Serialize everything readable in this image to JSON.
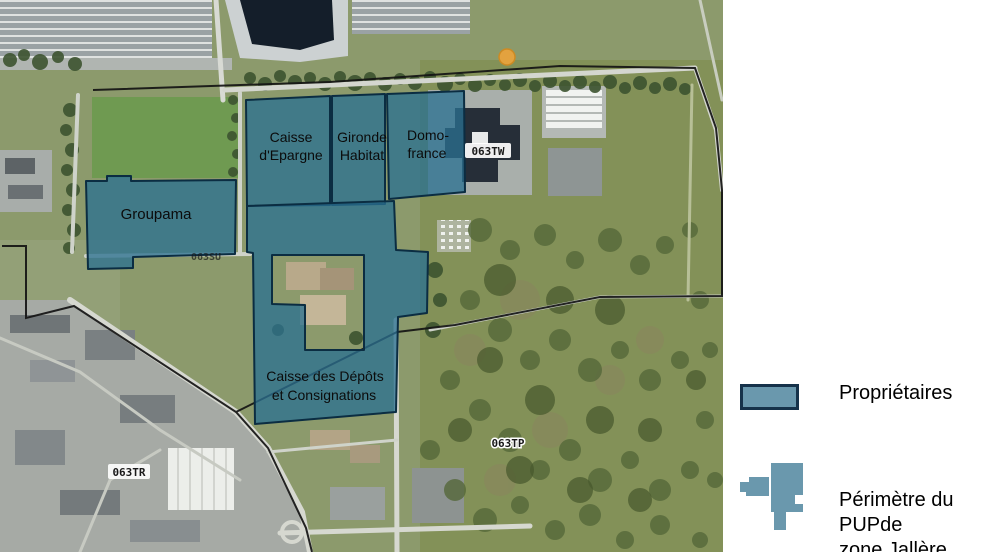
{
  "map": {
    "parcels": [
      {
        "id": "groupama",
        "lines": [
          "Groupama"
        ]
      },
      {
        "id": "caisse-epargne",
        "lines": [
          "Caisse",
          "d'Epargne"
        ]
      },
      {
        "id": "gironde-habitat",
        "lines": [
          "Gironde",
          "Habitat"
        ]
      },
      {
        "id": "domo-france",
        "lines": [
          "Domo-",
          "france"
        ]
      },
      {
        "id": "caisse-des-depots",
        "lines": [
          "Caisse des Dépôts",
          "et Consignations"
        ]
      }
    ],
    "road_labels": [
      {
        "code": "063TW"
      },
      {
        "code": "063TP"
      },
      {
        "code": "063TR"
      },
      {
        "code": "063SU"
      }
    ],
    "overlay_fill": "#2a7090",
    "overlay_outline": "#0b2d42",
    "perimeter_line": "#141414",
    "poi_dot_color": "#e8a33d"
  },
  "legend": {
    "items": [
      {
        "label": "Propriétaires",
        "swatch_color": "#6a98ad",
        "swatch_border": "#16324a"
      },
      {
        "lines": [
          "Périmètre du PUPde",
          "zone Jallère"
        ],
        "icon_color": "#6a98ad"
      }
    ]
  }
}
